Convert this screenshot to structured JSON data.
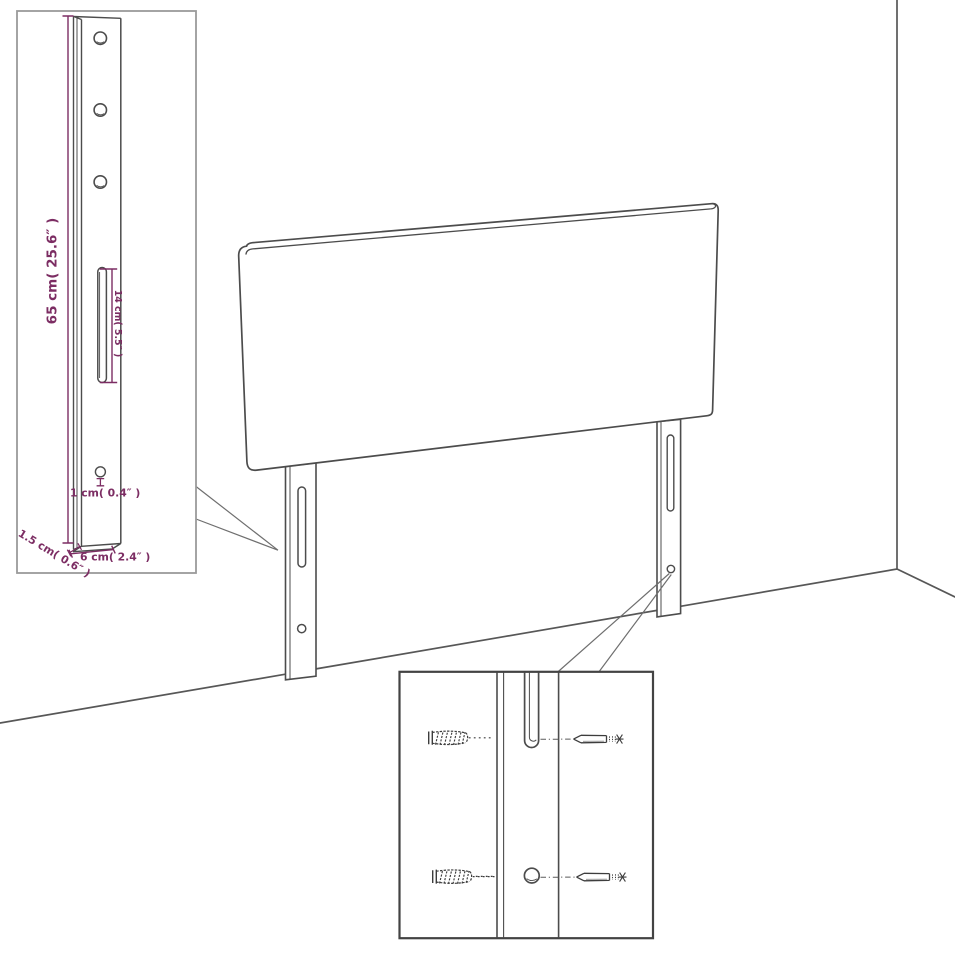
{
  "colors": {
    "background": "#ffffff",
    "drawing_line": "#4c4c4c",
    "floor_line": "#575757",
    "inset_border_light": "#9a9a9a",
    "inset_border_dark": "#434343",
    "leader_line": "#6f6f6f",
    "dimension_accent": "#7c2d63"
  },
  "inset_leg_detail": {
    "height_label": "65 cm( 25.6″ )",
    "slot_label": "14 cm( 5.5″ )",
    "hole_label": "1 cm( 0.4″ )",
    "depth_label": "1.5 cm( 0.6″ )",
    "width_label": "6 cm( 2.4″ )"
  }
}
